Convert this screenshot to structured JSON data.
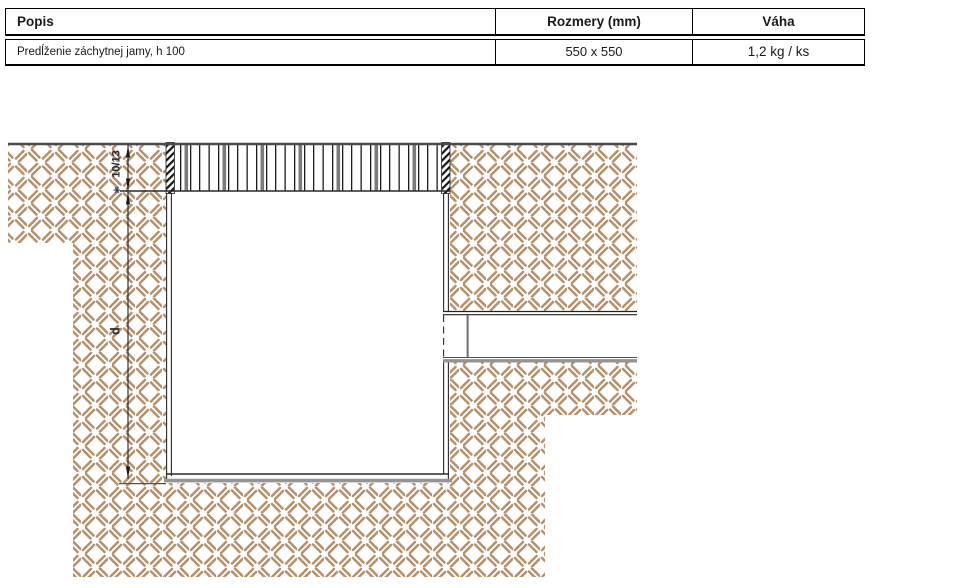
{
  "table": {
    "header": {
      "popis": "Popis",
      "rozmery": "Rozmery (mm)",
      "vaha": "Váha"
    },
    "row": {
      "popis": "Predĺženie záchytnej jamy, h 100",
      "rozmery": "550 x 550",
      "vaha": "1,2 kg / ks"
    }
  },
  "drawing": {
    "dim_grate_height": {
      "prefix": "∗",
      "label": "10/13"
    },
    "dim_depth_label": "d",
    "colors": {
      "ground_hatch": "#b5916e",
      "line_dark": "#2a2a2a",
      "line_gray": "#949494",
      "surface_line": "#4a4a4a",
      "dim_text": "#232a36",
      "footnote_star": "#2e4a6b"
    }
  }
}
